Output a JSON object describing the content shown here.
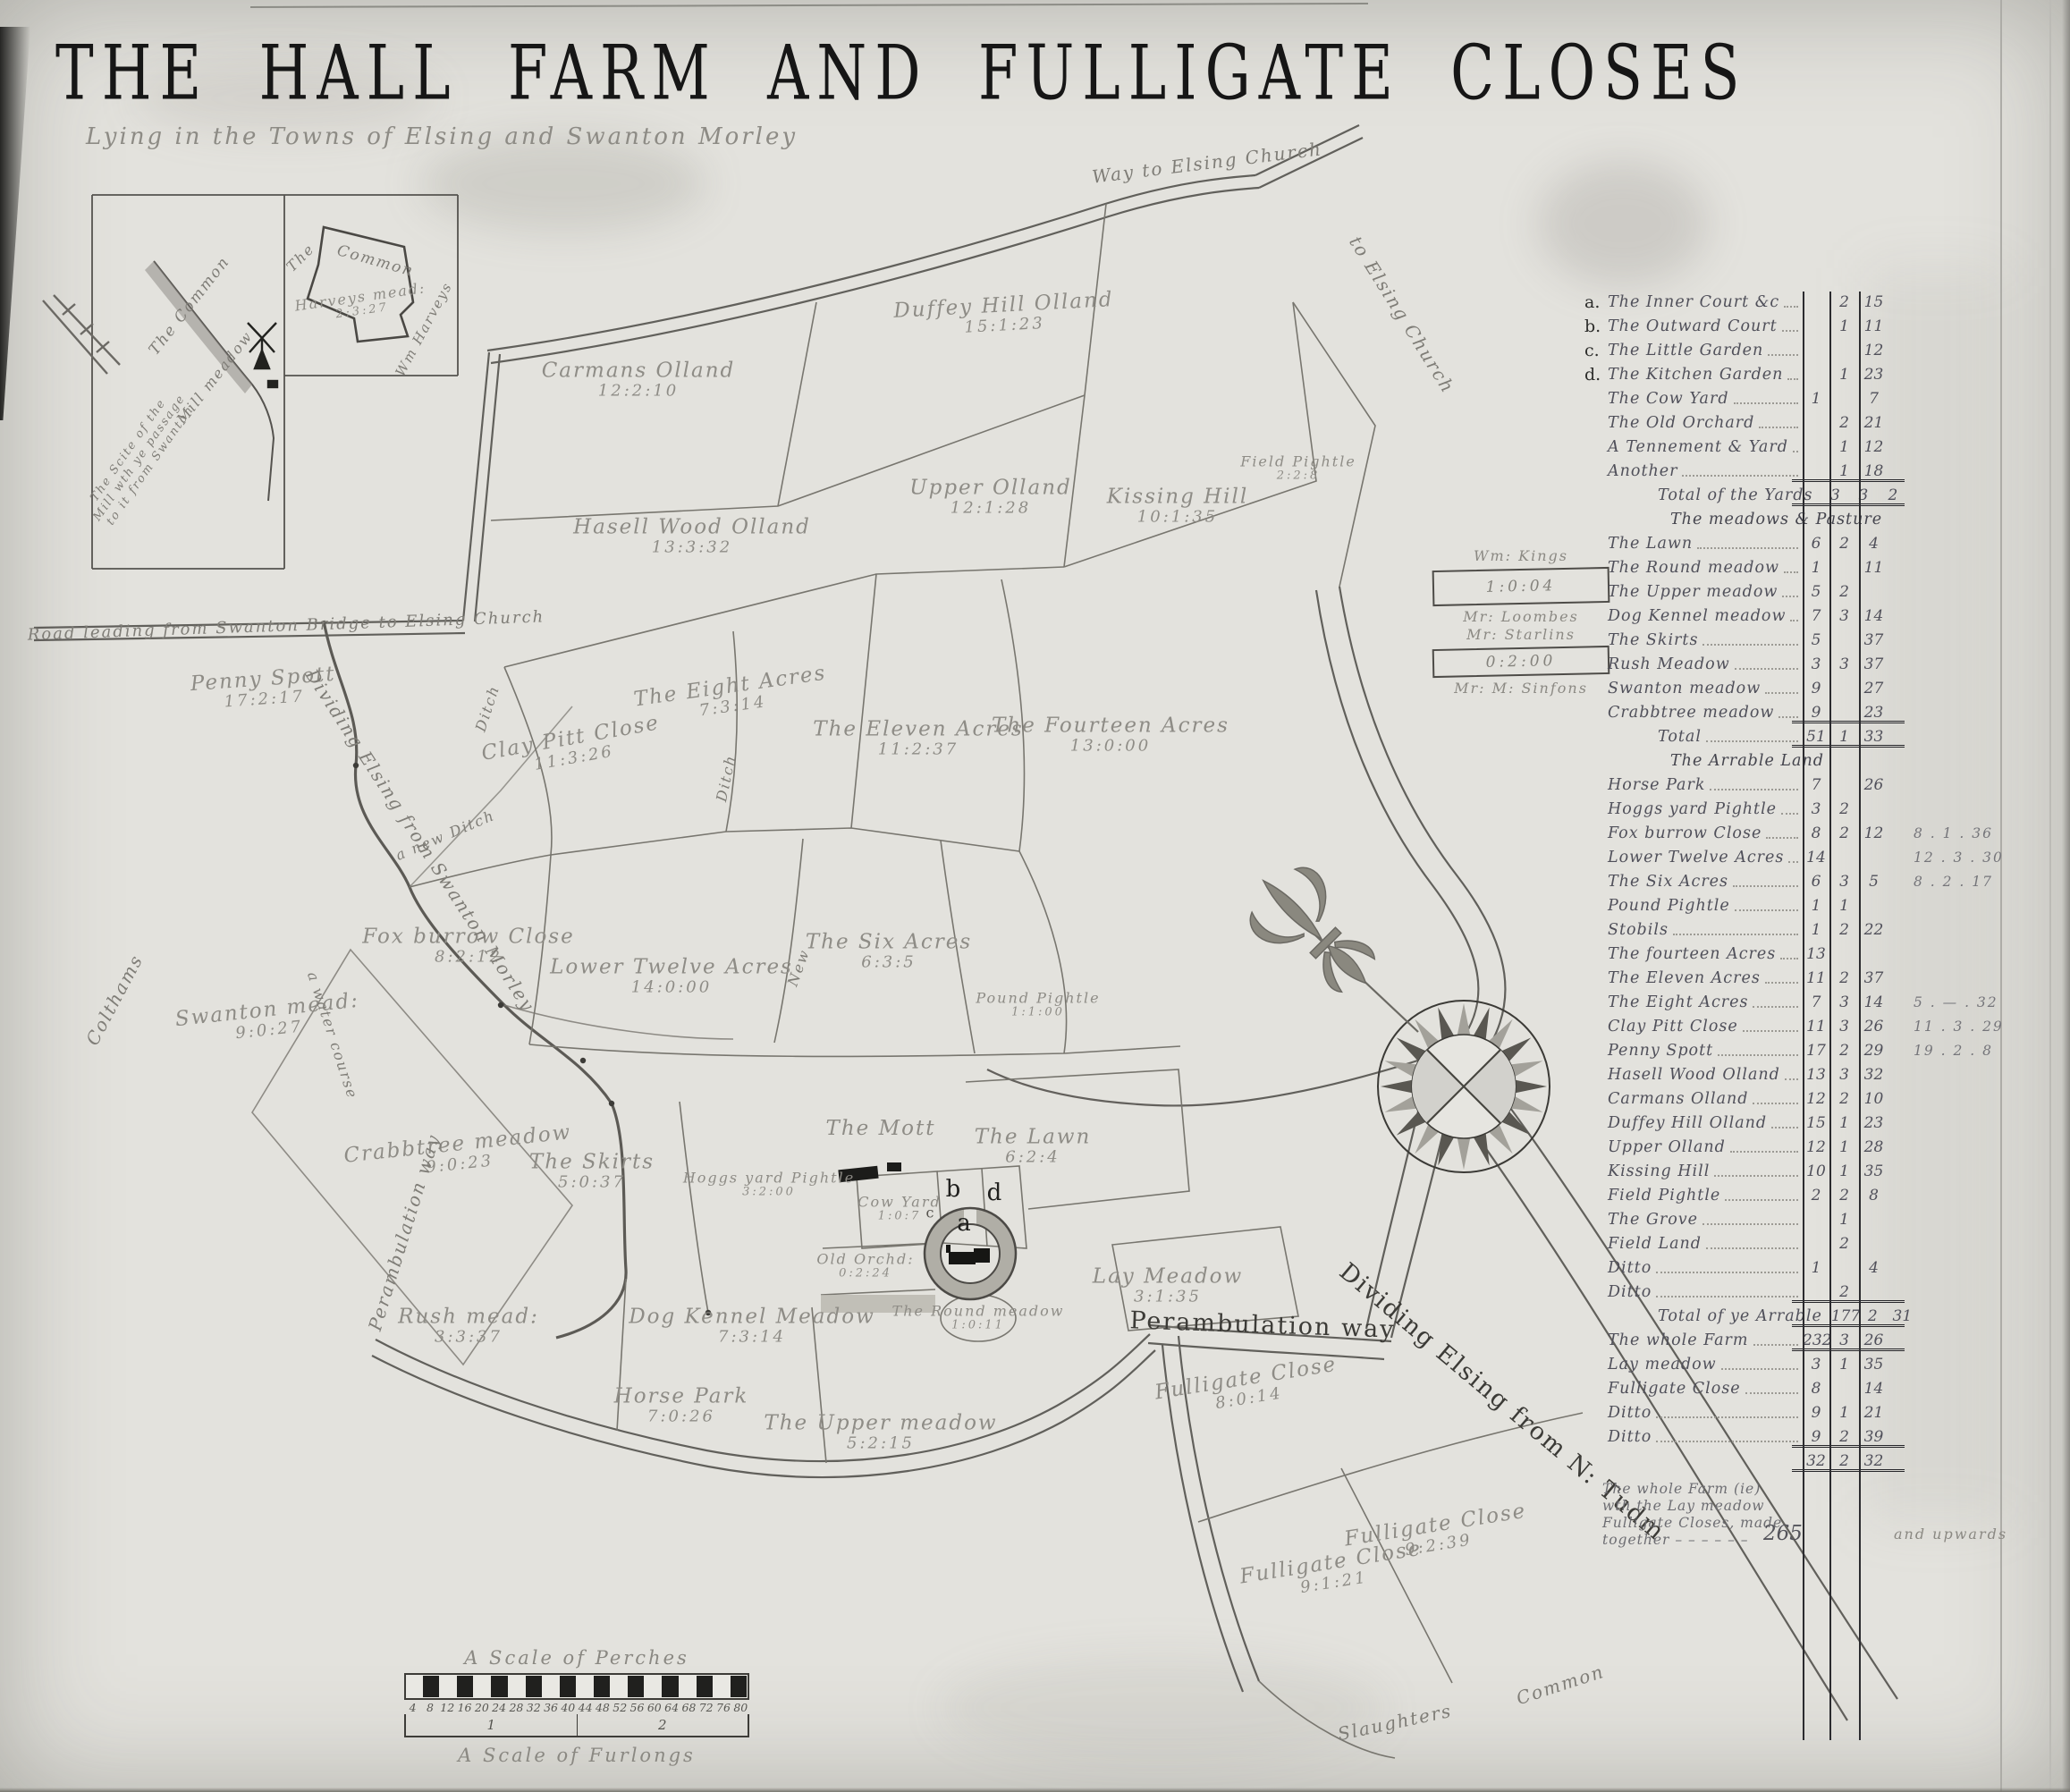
{
  "title": "THE HALL FARM AND FULLIGATE CLOSES",
  "subtitle": "Lying in the Towns of Elsing and Swanton Morley",
  "inset": {
    "common": "Common",
    "the": "The",
    "harveys_name": "Harveys mead:",
    "harveys_acreage": "2:3:27",
    "wm_harveys": "Wm Harveys",
    "the_common": "The Common",
    "mill_meadow": "Mill meadow",
    "scite_lines": [
      "The Scite of the",
      "Mill wth ye passage",
      "to it from Swanton"
    ]
  },
  "legend": {
    "owner1": "Wm: Kings",
    "box1": "1:0:04",
    "owner2": "Mr: Loombes",
    "owner3": "Mr: Starlins",
    "box2": "0:2:00",
    "owner4": "Mr: M: Sinfons"
  },
  "moat": {
    "a": "a",
    "b": "b",
    "c": "c",
    "d": "d"
  },
  "parcels": [
    {
      "name": "Duffey Hill Olland",
      "acreage": "15:1:23"
    },
    {
      "name": "Carmans Olland",
      "acreage": "12:2:10"
    },
    {
      "name": "Upper Olland",
      "acreage": "12:1:28"
    },
    {
      "name": "Kissing Hill",
      "acreage": "10:1:35"
    },
    {
      "name": "Field Pightle",
      "acreage": "2:2:8"
    },
    {
      "name": "Hasell Wood Olland",
      "acreage": "13:3:32"
    },
    {
      "name": "Penny Spott",
      "acreage": "17:2:17"
    },
    {
      "name": "Clay Pitt Close",
      "acreage": "11:3:26"
    },
    {
      "name": "The Eight Acres",
      "acreage": "7:3:14"
    },
    {
      "name": "The Eleven Acres",
      "acreage": "11:2:37"
    },
    {
      "name": "The Fourteen Acres",
      "acreage": "13:0:00"
    },
    {
      "name": "Fox burrow Close",
      "acreage": "8:2:12"
    },
    {
      "name": "Lower Twelve Acres",
      "acreage": "14:0:00"
    },
    {
      "name": "The Six Acres",
      "acreage": "6:3:5"
    },
    {
      "name": "Pound Pightle",
      "acreage": "1:1:00"
    },
    {
      "name": "Swanton mead:",
      "acreage": "9:0:27"
    },
    {
      "name": "Crabbtree meadow",
      "acreage": "9:0:23"
    },
    {
      "name": "The Skirts",
      "acreage": "5:0:37"
    },
    {
      "name": "Hoggs yard Pightle",
      "acreage": "3:2:00"
    },
    {
      "name": "The Mott",
      "acreage": ""
    },
    {
      "name": "The Lawn",
      "acreage": "6:2:4"
    },
    {
      "name": "Cow Yard",
      "acreage": "1:0:7"
    },
    {
      "name": "Old Orchd:",
      "acreage": "0:2:24"
    },
    {
      "name": "Lay Meadow",
      "acreage": "3:1:35"
    },
    {
      "name": "Dog Kennel Meadow",
      "acreage": "7:3:14"
    },
    {
      "name": "The Round meadow",
      "acreage": "1:0:11"
    },
    {
      "name": "Rush mead:",
      "acreage": "3:3:37"
    },
    {
      "name": "Horse Park",
      "acreage": "7:0:26"
    },
    {
      "name": "The Upper meadow",
      "acreage": "5:2:15"
    },
    {
      "name": "Fulligate Close",
      "acreage": "8:0:14"
    },
    {
      "name": "Fulligate Close",
      "acreage": "9:1:21"
    },
    {
      "name": "Fulligate Close",
      "acreage": "9:2:39"
    }
  ],
  "roads": [
    {
      "label": "Way to Elsing Church"
    },
    {
      "label": "to Elsing Church"
    },
    {
      "label": "Road leading from Swanton Bridge to Elsing Church"
    },
    {
      "label": "Dividing Elsing from Swanton Morley"
    },
    {
      "label": "Perambulation way"
    },
    {
      "label": "a new Ditch"
    },
    {
      "label": "Ditch"
    },
    {
      "label": "Ditch"
    },
    {
      "label": "New"
    },
    {
      "label": "Colthams"
    },
    {
      "label": "a water course"
    },
    {
      "label": "Perambulation way"
    },
    {
      "label": "Dividing Elsing from N: Tudm"
    },
    {
      "label": "Common"
    },
    {
      "label": "Slaughters"
    }
  ],
  "table": {
    "rows": [
      {
        "prefix": "a.",
        "label": "The Inner Court &c",
        "a": "",
        "r": "2",
        "p": "15",
        "extra": ""
      },
      {
        "prefix": "b.",
        "label": "The Outward Court",
        "a": "",
        "r": "1",
        "p": "11",
        "extra": ""
      },
      {
        "prefix": "c.",
        "label": "The Little Garden",
        "a": "",
        "r": "",
        "p": "12",
        "extra": ""
      },
      {
        "prefix": "d.",
        "label": "The Kitchen Garden",
        "a": "",
        "r": "1",
        "p": "23",
        "extra": ""
      },
      {
        "prefix": "",
        "label": "The Cow Yard",
        "a": "1",
        "r": "",
        "p": "7",
        "extra": ""
      },
      {
        "prefix": "",
        "label": "The Old Orchard",
        "a": "",
        "r": "2",
        "p": "21",
        "extra": ""
      },
      {
        "prefix": "",
        "label": "A Tennement & Yard",
        "a": "",
        "r": "1",
        "p": "12",
        "extra": ""
      },
      {
        "prefix": "",
        "label": "Another",
        "a": "",
        "r": "1",
        "p": "18",
        "extra": ""
      },
      {
        "prefix": "",
        "label": "Total of the Yards",
        "a": "3",
        "r": "3",
        "p": "2",
        "extra": "",
        "cls": "total indent"
      },
      {
        "prefix": "",
        "label": "The meadows & Pasture",
        "a": "",
        "r": "",
        "p": "",
        "extra": "",
        "cls": "head"
      },
      {
        "prefix": "",
        "label": "The Lawn",
        "a": "6",
        "r": "2",
        "p": "4",
        "extra": ""
      },
      {
        "prefix": "",
        "label": "The Round meadow",
        "a": "1",
        "r": "",
        "p": "11",
        "extra": ""
      },
      {
        "prefix": "",
        "label": "The Upper meadow",
        "a": "5",
        "r": "2",
        "p": "",
        "extra": ""
      },
      {
        "prefix": "",
        "label": "Dog Kennel meadow",
        "a": "7",
        "r": "3",
        "p": "14",
        "extra": ""
      },
      {
        "prefix": "",
        "label": "The Skirts",
        "a": "5",
        "r": "",
        "p": "37",
        "extra": ""
      },
      {
        "prefix": "",
        "label": "Rush Meadow",
        "a": "3",
        "r": "3",
        "p": "37",
        "extra": ""
      },
      {
        "prefix": "",
        "label": "Swanton meadow",
        "a": "9",
        "r": "",
        "p": "27",
        "extra": ""
      },
      {
        "prefix": "",
        "label": "Crabbtree meadow",
        "a": "9",
        "r": "",
        "p": "23",
        "extra": ""
      },
      {
        "prefix": "",
        "label": "Total",
        "a": "51",
        "r": "1",
        "p": "33",
        "extra": "",
        "cls": "total indent"
      },
      {
        "prefix": "",
        "label": "The Arrable Land",
        "a": "",
        "r": "",
        "p": "",
        "extra": "",
        "cls": "head"
      },
      {
        "prefix": "",
        "label": "Horse Park",
        "a": "7",
        "r": "",
        "p": "26",
        "extra": ""
      },
      {
        "prefix": "",
        "label": "Hoggs yard Pightle",
        "a": "3",
        "r": "2",
        "p": "",
        "extra": ""
      },
      {
        "prefix": "",
        "label": "Fox burrow Close",
        "a": "8",
        "r": "2",
        "p": "12",
        "extra": "8 . 1 . 36"
      },
      {
        "prefix": "",
        "label": "Lower Twelve Acres",
        "a": "14",
        "r": "",
        "p": "",
        "extra": "12 . 3 . 30"
      },
      {
        "prefix": "",
        "label": "The Six Acres",
        "a": "6",
        "r": "3",
        "p": "5",
        "extra": "8 . 2 . 17"
      },
      {
        "prefix": "",
        "label": "Pound Pightle",
        "a": "1",
        "r": "1",
        "p": "",
        "extra": ""
      },
      {
        "prefix": "",
        "label": "Stobils",
        "a": "1",
        "r": "2",
        "p": "22",
        "extra": ""
      },
      {
        "prefix": "",
        "label": "The fourteen Acres",
        "a": "13",
        "r": "",
        "p": "",
        "extra": ""
      },
      {
        "prefix": "",
        "label": "The Eleven Acres",
        "a": "11",
        "r": "2",
        "p": "37",
        "extra": ""
      },
      {
        "prefix": "",
        "label": "The Eight Acres",
        "a": "7",
        "r": "3",
        "p": "14",
        "extra": "5 . — . 32"
      },
      {
        "prefix": "",
        "label": "Clay Pitt Close",
        "a": "11",
        "r": "3",
        "p": "26",
        "extra": "11 . 3 . 29"
      },
      {
        "prefix": "",
        "label": "Penny Spott",
        "a": "17",
        "r": "2",
        "p": "29",
        "extra": "19 . 2 . 8"
      },
      {
        "prefix": "",
        "label": "Hasell Wood Olland",
        "a": "13",
        "r": "3",
        "p": "32",
        "extra": ""
      },
      {
        "prefix": "",
        "label": "Carmans Olland",
        "a": "12",
        "r": "2",
        "p": "10",
        "extra": ""
      },
      {
        "prefix": "",
        "label": "Duffey Hill Olland",
        "a": "15",
        "r": "1",
        "p": "23",
        "extra": ""
      },
      {
        "prefix": "",
        "label": "Upper Olland",
        "a": "12",
        "r": "1",
        "p": "28",
        "extra": ""
      },
      {
        "prefix": "",
        "label": "Kissing Hill",
        "a": "10",
        "r": "1",
        "p": "35",
        "extra": ""
      },
      {
        "prefix": "",
        "label": "Field Pightle",
        "a": "2",
        "r": "2",
        "p": "8",
        "extra": ""
      },
      {
        "prefix": "",
        "label": "The Grove",
        "a": "",
        "r": "1",
        "p": "",
        "extra": ""
      },
      {
        "prefix": "",
        "label": "Field Land",
        "a": "",
        "r": "2",
        "p": "",
        "extra": ""
      },
      {
        "prefix": "",
        "label": "Ditto",
        "a": "1",
        "r": "",
        "p": "4",
        "extra": ""
      },
      {
        "prefix": "",
        "label": "Ditto",
        "a": "",
        "r": "2",
        "p": "",
        "extra": ""
      },
      {
        "prefix": "",
        "label": "Total of ye Arrable",
        "a": "177",
        "r": "2",
        "p": "31",
        "extra": "",
        "cls": "total indent"
      },
      {
        "prefix": "",
        "label": "The whole Farm",
        "a": "232",
        "r": "3",
        "p": "26",
        "extra": "",
        "cls": "total"
      },
      {
        "prefix": "",
        "label": "Lay meadow",
        "a": "3",
        "r": "1",
        "p": "35",
        "extra": ""
      },
      {
        "prefix": "",
        "label": "Fulligate Close",
        "a": "8",
        "r": "",
        "p": "14",
        "extra": ""
      },
      {
        "prefix": "",
        "label": "Ditto",
        "a": "9",
        "r": "1",
        "p": "21",
        "extra": ""
      },
      {
        "prefix": "",
        "label": "Ditto",
        "a": "9",
        "r": "2",
        "p": "39",
        "extra": ""
      },
      {
        "prefix": "",
        "label": "",
        "a": "32",
        "r": "2",
        "p": "32",
        "extra": "",
        "cls": "total sum"
      }
    ],
    "note_lines": [
      "The whole Farm (ie)",
      "wth the Lay meadow",
      "Fulligate Closes, made",
      "together  – – – – – –"
    ],
    "note_total": "265",
    "note_suffix": "and upwards"
  },
  "scale": {
    "perches_title": "A Scale of Perches",
    "furlongs_title": "A Scale of Furlongs",
    "numbers": [
      "4",
      "8",
      "12",
      "16",
      "20",
      "24",
      "28",
      "32",
      "36",
      "40",
      "44",
      "48",
      "52",
      "56",
      "60",
      "64",
      "68",
      "72",
      "76",
      "80"
    ],
    "furlong_marks": [
      "1",
      "2"
    ]
  }
}
